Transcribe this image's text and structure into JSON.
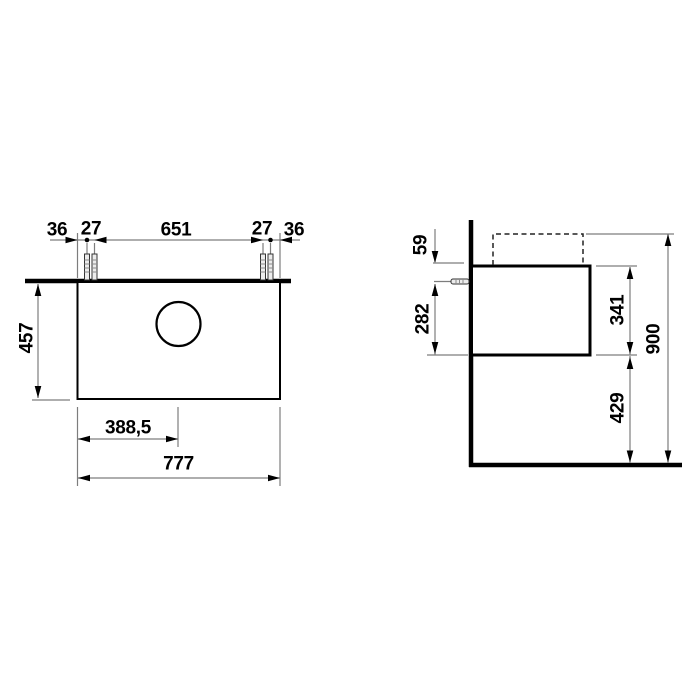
{
  "views": {
    "plan": {
      "wall_offset_left": "36",
      "bolt_gap_left": "27",
      "bolt_span": "651",
      "bolt_gap_right": "27",
      "wall_offset_right": "36",
      "depth": "457",
      "hole_center_from_left": "388,5",
      "total_width": "777"
    },
    "side": {
      "top_to_anchor": "59",
      "anchor_to_bottom": "282",
      "body_height": "341",
      "floor_clearance": "429",
      "total_mount_height": "900"
    }
  },
  "colors": {
    "object_line": "#000000",
    "dimension_line": "#7d7d7d",
    "background": "#ffffff"
  }
}
